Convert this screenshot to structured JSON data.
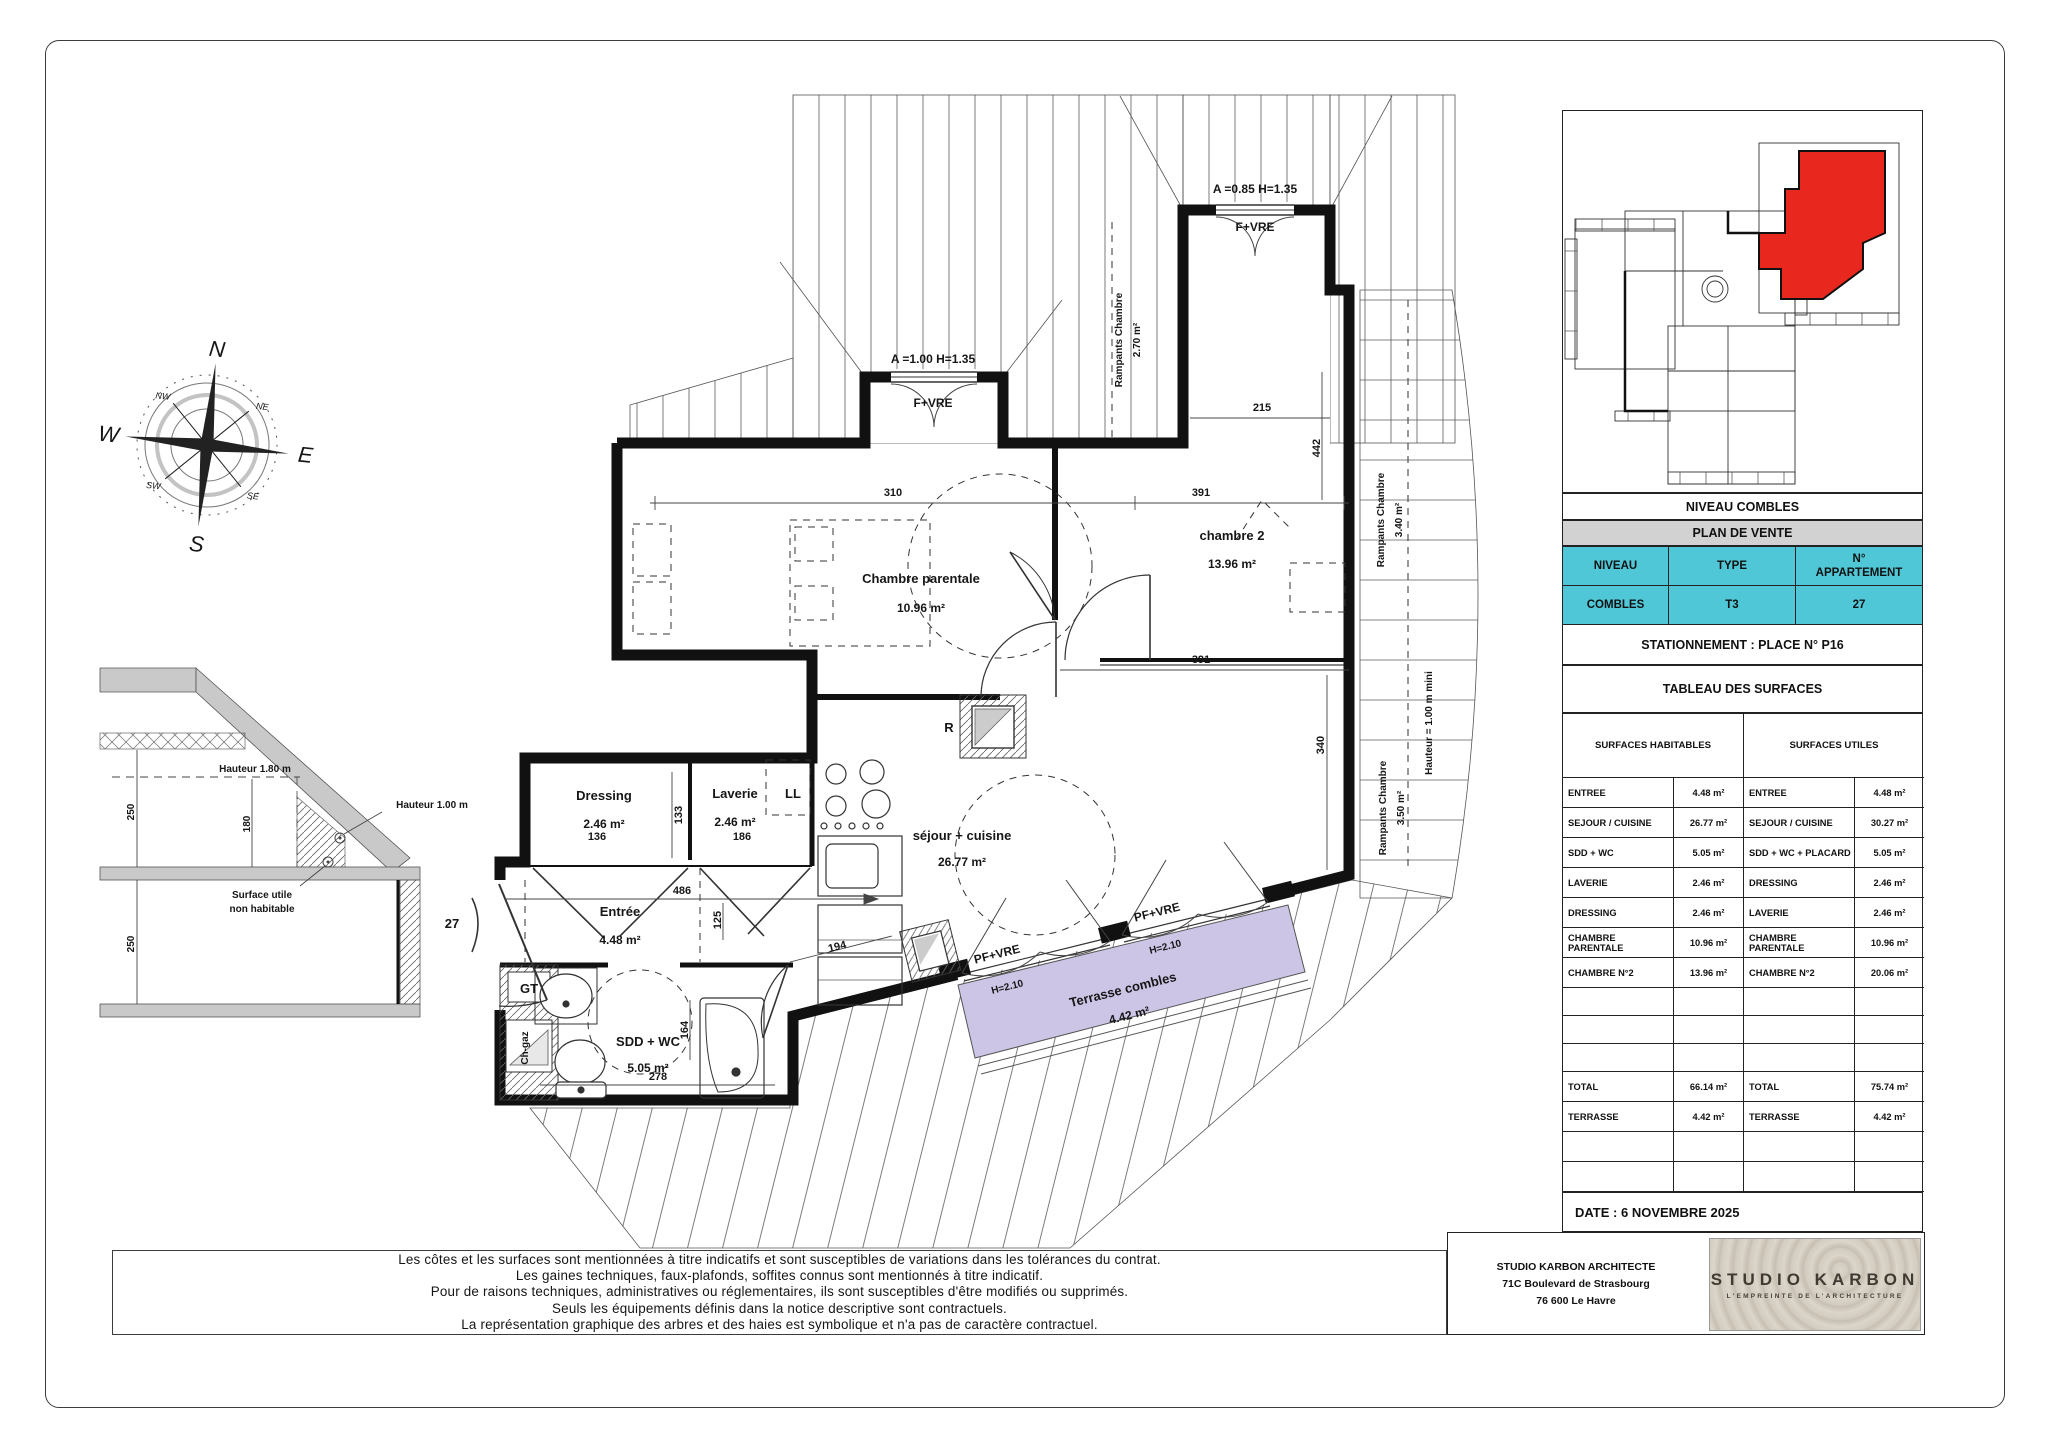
{
  "colors": {
    "accent_cyan": "#4fc7d6",
    "terrace_purple": "#cdc5e6",
    "unit_red": "#e8281e",
    "header_gray": "#d2d2d2",
    "wall_black": "#111111"
  },
  "compass": {
    "n": "N",
    "e": "E",
    "s": "S",
    "w": "W",
    "nw": "NW",
    "ne": "NE",
    "sw": "SW",
    "se": "SE"
  },
  "section": {
    "h180": "Hauteur 1.80 m",
    "h100": "Hauteur 1.00 m",
    "surface_l1": "Surface utile",
    "surface_l2": "non habitable",
    "d250a": "250",
    "d180": "180",
    "d250b": "250"
  },
  "plan": {
    "rooms": {
      "parentale": {
        "name": "Chambre parentale",
        "area": "10.96 m²"
      },
      "chambre2": {
        "name": "chambre 2",
        "area": "13.96 m²"
      },
      "sejour": {
        "name": "séjour + cuisine",
        "area": "26.77 m²"
      },
      "dressing": {
        "name": "Dressing",
        "area": "2.46 m²"
      },
      "laverie": {
        "name": "Laverie",
        "area": "2.46 m²"
      },
      "entree": {
        "name": "Entrée",
        "area": "4.48 m²"
      },
      "sdd": {
        "name": "SDD + WC",
        "area": "5.05 m²"
      },
      "terrasse": {
        "name": "Terrasse combles",
        "area": "4.42 m²"
      }
    },
    "labels": {
      "ll": "LL",
      "gt": "GT",
      "chgaz": "Ch-gaz",
      "r": "R",
      "door_number": "27",
      "rampants1_l1": "Rampants Chambre",
      "rampants1_l2": "2.70 m²",
      "rampants2_l1": "Rampants Chambre",
      "rampants2_l2": "3.40 m²",
      "rampants3_l1": "Rampants Chambre",
      "rampants3_l2": "3.50 m²",
      "hauteur_mini": "Hauteur = 1.00 m mini",
      "a100": "A =1.00 H=1.35",
      "a085": "A =0.85 H=1.35",
      "fvre": "F+VRE",
      "pfvre": "PF+VRE",
      "h210": "H=2.10"
    },
    "dims": {
      "d310": "310",
      "d391a": "391",
      "d391b": "391",
      "d215": "215",
      "d442": "442",
      "d340": "340",
      "d486": "486",
      "d125": "125",
      "d133": "133",
      "d136": "136",
      "d186": "186",
      "d194": "194",
      "d164": "164",
      "d278": "278"
    }
  },
  "panel": {
    "inset_title": "NIVEAU COMBLES",
    "plan_de_vente": "PLAN DE VENTE",
    "niveau_h": "NIVEAU",
    "type_h": "TYPE",
    "apt_h1": "N°",
    "apt_h2": "APPARTEMENT",
    "niveau_v": "COMBLES",
    "type_v": "T3",
    "apt_v": "27",
    "stationnement": "STATIONNEMENT : PLACE N° P16",
    "surfaces_title": "TABLEAU DES SURFACES",
    "hab_header": "SURFACES HABITABLES",
    "util_header": "SURFACES UTILES",
    "hab_rows": [
      {
        "l": "ENTREE",
        "v": "4.48 m²"
      },
      {
        "l": "SEJOUR / CUISINE",
        "v": "26.77 m²"
      },
      {
        "l": "SDD + WC",
        "v": "5.05 m²"
      },
      {
        "l": "LAVERIE",
        "v": "2.46 m²"
      },
      {
        "l": "DRESSING",
        "v": "2.46 m²"
      },
      {
        "l": "CHAMBRE PARENTALE",
        "v": "10.96 m²"
      },
      {
        "l": "CHAMBRE N°2",
        "v": "13.96 m²"
      }
    ],
    "util_rows": [
      {
        "l": "ENTREE",
        "v": "4.48 m²"
      },
      {
        "l": "SEJOUR / CUISINE",
        "v": "30.27 m²"
      },
      {
        "l": "SDD + WC + PLACARD",
        "v": "5.05 m²"
      },
      {
        "l": "DRESSING",
        "v": "2.46 m²"
      },
      {
        "l": "LAVERIE",
        "v": "2.46 m²"
      },
      {
        "l": "CHAMBRE PARENTALE",
        "v": "10.96 m²"
      },
      {
        "l": "CHAMBRE N°2",
        "v": "20.06 m²"
      }
    ],
    "hab_total": {
      "l": "TOTAL",
      "v": "66.14 m²"
    },
    "util_total": {
      "l": "TOTAL",
      "v": "75.74 m²"
    },
    "hab_terrasse": {
      "l": "TERRASSE",
      "v": "4.42 m²"
    },
    "util_terrasse": {
      "l": "TERRASSE",
      "v": "4.42 m²"
    },
    "date": "DATE : 6 NOVEMBRE 2025",
    "architect_l1": "STUDIO KARBON ARCHITECTE",
    "architect_l2": "71C Boulevard de Strasbourg",
    "architect_l3": "76 600 Le Havre",
    "logo_title": "STUDIO KARBON",
    "logo_sub": "L'EMPREINTE DE L'ARCHITECTURE"
  },
  "disclaimer": {
    "l1": "Les côtes et les surfaces sont mentionnées à titre indicatifs et sont susceptibles de variations dans les tolérances du contrat.",
    "l2": "Les gaines techniques, faux-plafonds, soffites connus sont mentionnés à titre indicatif.",
    "l3": "Pour de raisons techniques, administratives ou réglementaires, ils sont susceptibles d'être modifiés ou supprimés.",
    "l4": "Seuls les équipements définis dans la notice descriptive sont contractuels.",
    "l5": "La représentation graphique  des arbres et des haies est symbolique et n'a pas de caractère contractuel."
  }
}
